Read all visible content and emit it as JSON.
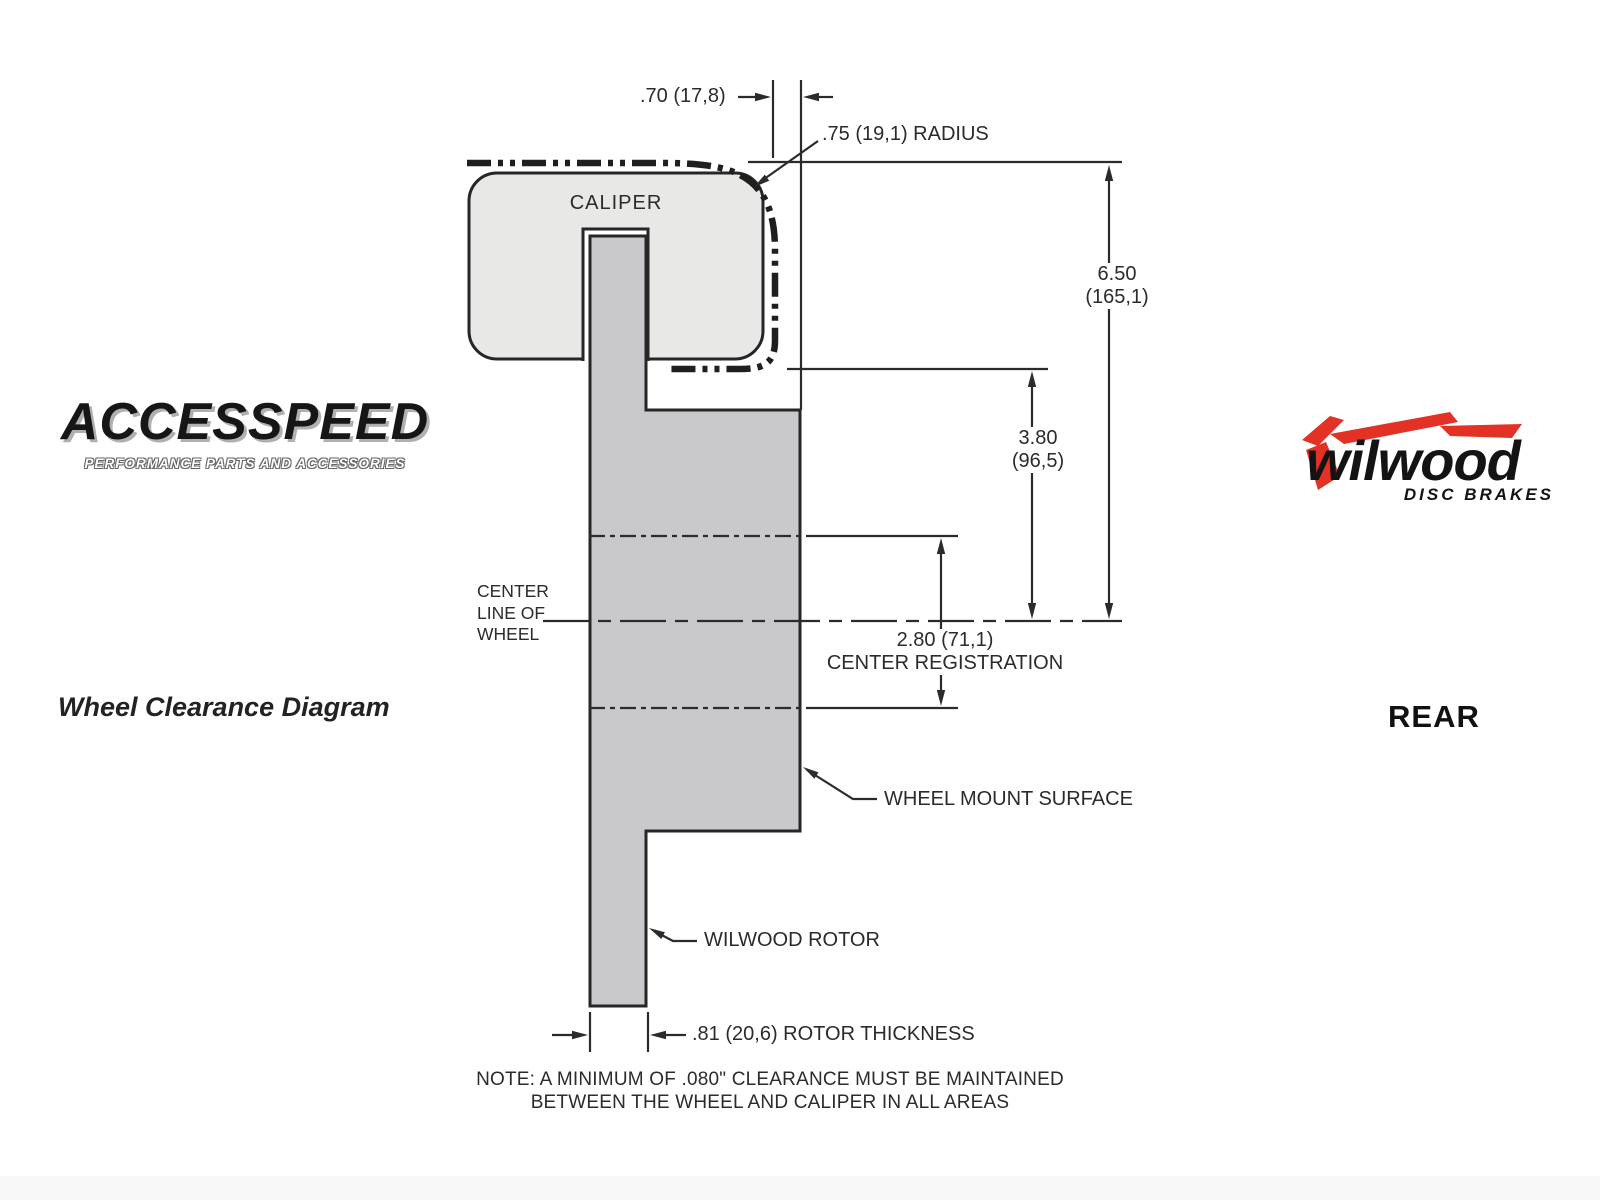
{
  "branding": {
    "accesspeed": {
      "wordmark": "ACCESSPEED",
      "tagline": "PERFORMANCE PARTS AND ACCESSORIES"
    },
    "left_caption": "Wheel Clearance Diagram",
    "wilwood": {
      "wordmark": "wilwood",
      "tagline": "DISC BRAKES",
      "red": "#e23125"
    },
    "right_caption": "REAR"
  },
  "diagram": {
    "caliper_label": "CALIPER",
    "center_line_label": {
      "line1": "CENTER",
      "line2": "LINE OF",
      "line3": "WHEEL"
    },
    "wheel_mount_label": "WHEEL MOUNT SURFACE",
    "rotor_label": "WILWOOD ROTOR",
    "dim_caliper_overhang": ".70 (17,8)",
    "dim_radius": ".75 (19,1) RADIUS",
    "dim_overall": {
      "value": "6.50",
      "metric": "(165,1)"
    },
    "dim_mount_to_center": {
      "value": "3.80",
      "metric": "(96,5)"
    },
    "dim_center_registration": {
      "value": "2.80 (71,1)",
      "label": "CENTER REGISTRATION"
    },
    "dim_rotor_thickness": ".81 (20,6) ROTOR THICKNESS",
    "note_line1": "NOTE: A MINIMUM OF .080\" CLEARANCE MUST BE MAINTAINED",
    "note_line2": "BETWEEN THE WHEEL AND CALIPER IN ALL AREAS",
    "colors": {
      "caliper_fill": "#e8e8e6",
      "rotor_fill": "#c9c9cd",
      "line": "#2b2b2b"
    }
  }
}
